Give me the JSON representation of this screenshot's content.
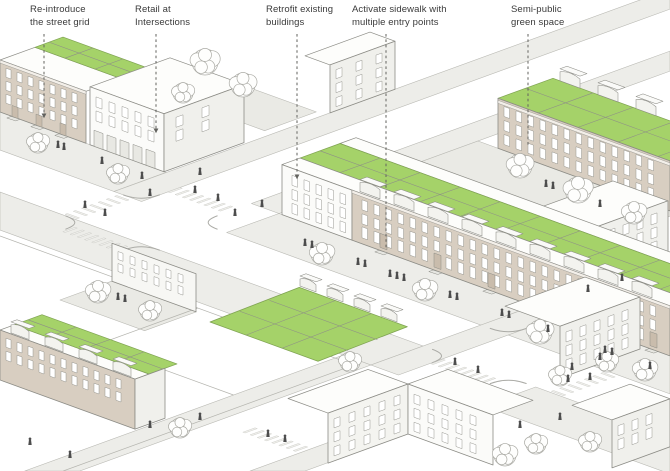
{
  "diagram": {
    "name": "urban-retrofit-axonometric-diagram",
    "type": "architectural-axonometric"
  },
  "annotations": [
    {
      "name": "re-introduce-street-grid",
      "label": "Re-introduce\nthe street grid",
      "text_x": 30,
      "line_x": 44,
      "line_top": 34,
      "line_end_y": 117,
      "arrow": true
    },
    {
      "name": "retail-at-intersections",
      "label": "Retail at\nIntersections",
      "text_x": 135,
      "line_x": 156,
      "line_top": 34,
      "line_end_y": 132,
      "arrow": true
    },
    {
      "name": "retrofit-existing-buildings",
      "label": "Retrofit existing\nbuildings",
      "text_x": 266,
      "line_x": 297,
      "line_top": 34,
      "line_end_y": 178,
      "arrow": true
    },
    {
      "name": "activate-sidewalk-entries",
      "label": "Activate sidewalk with\nmultiple entry points",
      "text_x": 352,
      "line_x": 386,
      "line_top": 34,
      "line_end_y": 250,
      "arrow": false
    },
    {
      "name": "semi-public-green-space",
      "label": "Semi-public\ngreen space",
      "text_x": 511,
      "line_x": 528,
      "line_top": 34,
      "line_end_y": 146,
      "arrow": false
    }
  ],
  "colors": {
    "accent_green": "#A5D269",
    "green_edge": "#7FA352",
    "grid_line": "#8E8E88",
    "facade_tan": "#D8CEC1",
    "facade_tan_dark": "#C9BCAC",
    "cornice": "#F3EFE9",
    "face_white": "#FBFBF9",
    "face_shaded": "#F0F0EC",
    "roof_white": "#FDFDFB",
    "roof_box": "#F3F3EF",
    "sidewalk": "#EDEDE9",
    "paving": "#EAEAE5",
    "curb": "#ABABA6",
    "outline": "#8C8C86",
    "window": "#FFFFFF",
    "people": "#4D4D4D",
    "tree_stroke": "#ABABA5",
    "tree_fill": "#FEFEFD",
    "leader_line": "#62625E",
    "label_text": "#3A3A3A"
  }
}
